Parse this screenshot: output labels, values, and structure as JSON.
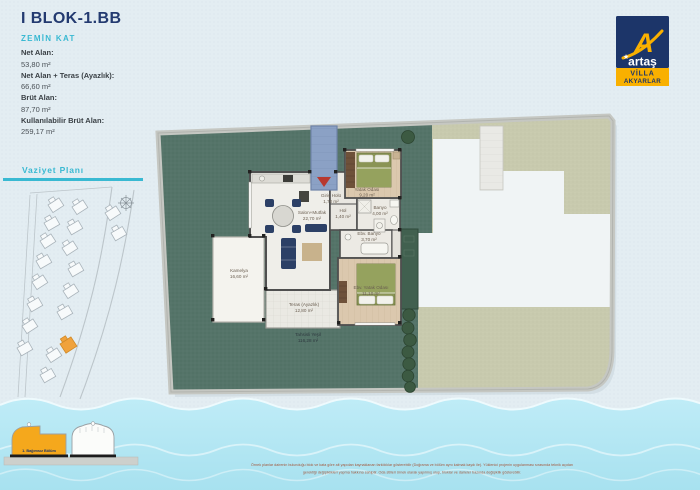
{
  "header": {
    "title": "I BLOK-1.BB",
    "subtitle": "ZEMİN KAT"
  },
  "stats": [
    {
      "label": "Net Alan:",
      "value": "53,80 m²"
    },
    {
      "label": "Net Alan + Teras (Ayazlık):",
      "value": "66,60 m²"
    },
    {
      "label": "Brüt Alan:",
      "value": "87,70 m²"
    },
    {
      "label": "Kullanılabilir Brüt Alan:",
      "value": "259,17 m²"
    }
  ],
  "vaziyet": {
    "title": "Vaziyet Planı"
  },
  "section": {
    "label": "1. Bağımsız Bölüm"
  },
  "logo": {
    "mark": "A",
    "brand": "artaş",
    "project_line1": "VİLLA",
    "project_line2": "AKYARLAR"
  },
  "plan": {
    "rooms": [
      {
        "name": "Giriş Holü",
        "area": "1,70 m²"
      },
      {
        "name": "Salon+Mutfak",
        "area": "22,70 m²"
      },
      {
        "name": "Hol",
        "area": "1,40 m²"
      },
      {
        "name": "Yatak Odası",
        "area": "9,20 m²"
      },
      {
        "name": "Banyo",
        "area": "4,00 m²"
      },
      {
        "name": "Ebv. Banyo",
        "area": "3,70 m²"
      },
      {
        "name": "Ebv. Yatak Odası",
        "area": "11,10 m²"
      },
      {
        "name": "Kamelya",
        "area": "16,60 m²"
      },
      {
        "name": "Teras (Ayazlık)",
        "area": "12,80 m²"
      },
      {
        "name": "Tahsisli Yeşil",
        "area": "116,28 m²"
      }
    ]
  },
  "disclaimer": {
    "line1": "Örnek planlar dairenin bulunduğu blok ve kata göre alt yapıdan kaynaklanan farklılıklar gösterebilir (Doğrama ve bölüm aynı kalmak kaydı ile). Yüklenici projenin uygulanması sırasında teknik açıdan",
    "line2": "gerektiği değişiklikleri yapma hakkına sahiptir. Oda stilleri örnek olarak yapılmış olup, bloklar ve daireler bazında değişiklik gösterebilir."
  },
  "colors": {
    "navy": "#233a70",
    "cyan": "#39b9d2",
    "accent_orange": "#f5a81c",
    "logo_navy": "#1c3569",
    "logo_yellow": "#f9b000",
    "water": "#b2e6f3",
    "garden_green": "#557469",
    "neighbor_khaki": "#c8caae",
    "disclaimer_red": "#a2593f"
  }
}
